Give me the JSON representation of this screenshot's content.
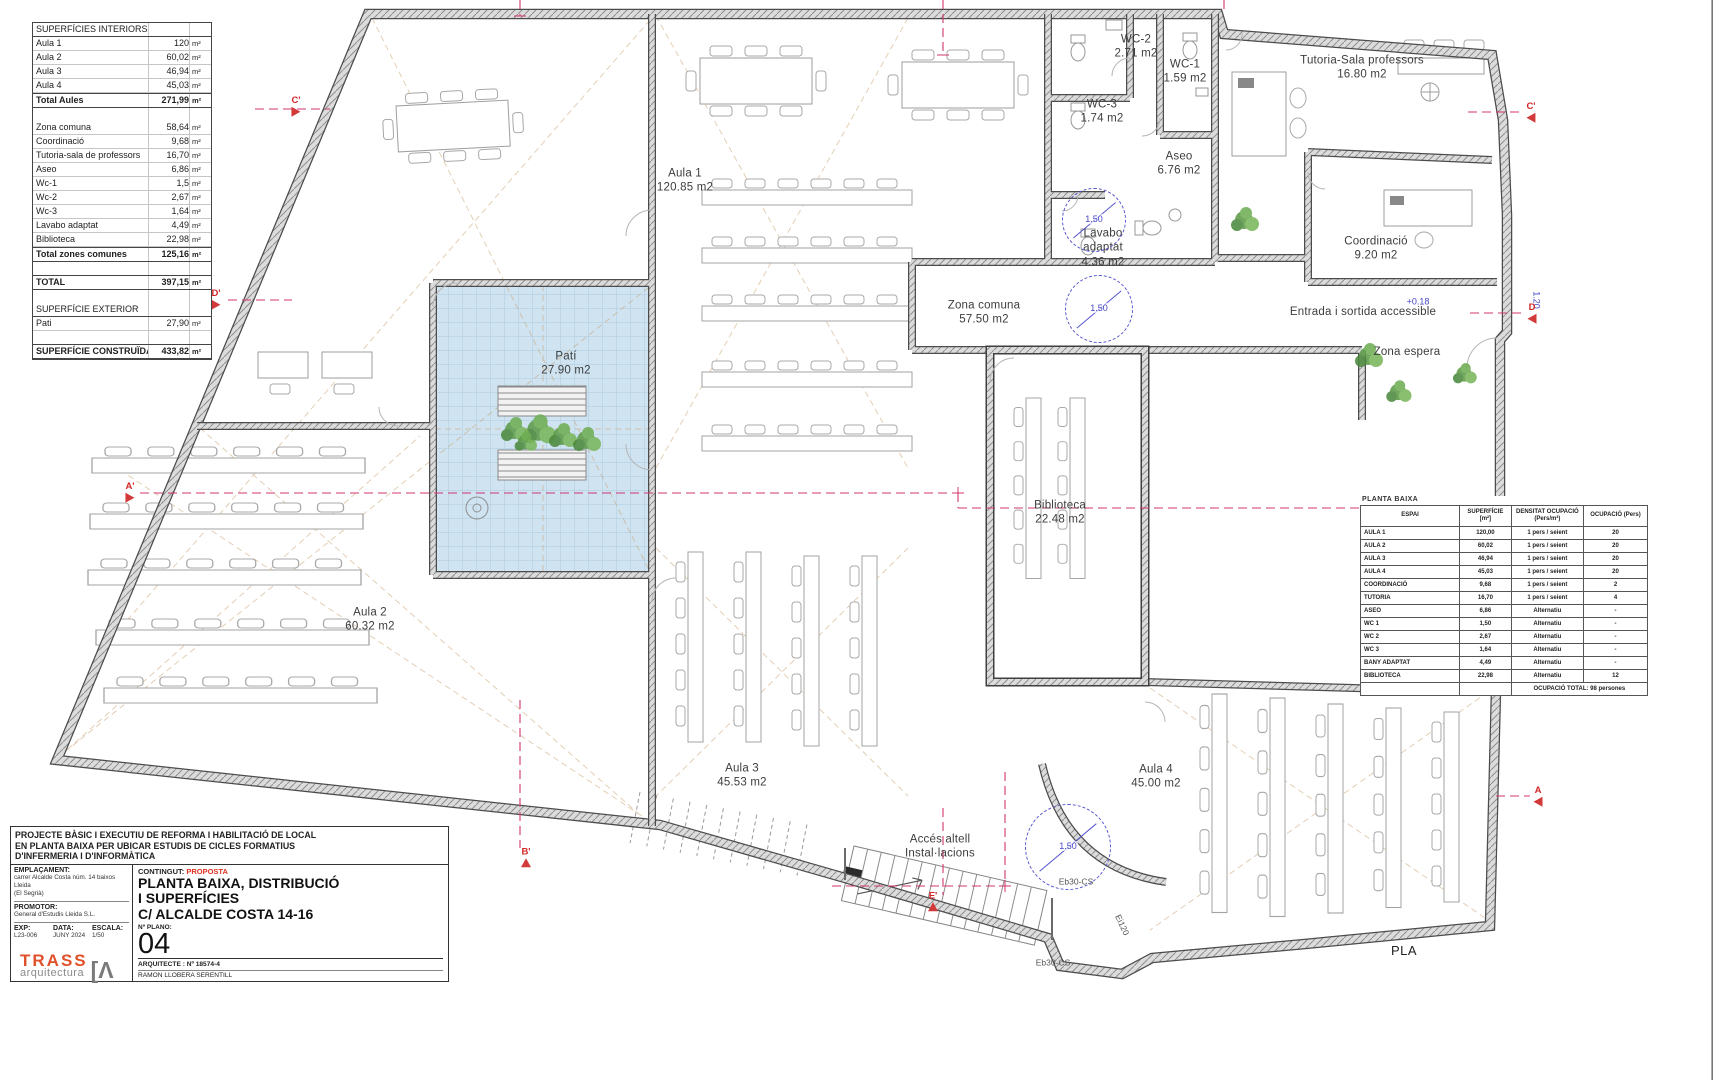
{
  "surfaces_table": {
    "rows": [
      {
        "label": "SUPERFÍCIES INTERIORS",
        "value": "",
        "unit": "",
        "style": "h"
      },
      {
        "label": "Aula 1",
        "value": "120",
        "unit": "m²"
      },
      {
        "label": "Aula 2",
        "value": "60,02",
        "unit": "m²"
      },
      {
        "label": "Aula 3",
        "value": "46,94",
        "unit": "m²"
      },
      {
        "label": "Aula 4",
        "value": "45,03",
        "unit": "m²"
      },
      {
        "label": "Total Aules",
        "value": "271,99",
        "unit": "m²",
        "style": "hb"
      },
      {
        "label": "",
        "value": "",
        "unit": "",
        "style": "blank"
      },
      {
        "label": "Zona comuna",
        "value": "58,64",
        "unit": "m²"
      },
      {
        "label": "Coordinació",
        "value": "9,68",
        "unit": "m²"
      },
      {
        "label": "Tutoria-sala de professors",
        "value": "16,70",
        "unit": "m²"
      },
      {
        "label": "Aseo",
        "value": "6,86",
        "unit": "m²"
      },
      {
        "label": "Wc-1",
        "value": "1,5",
        "unit": "m²"
      },
      {
        "label": "Wc-2",
        "value": "2,67",
        "unit": "m²"
      },
      {
        "label": "Wc-3",
        "value": "1,64",
        "unit": "m²"
      },
      {
        "label": "Lavabo adaptat",
        "value": "4,49",
        "unit": "m²"
      },
      {
        "label": "Biblioteca",
        "value": "22,98",
        "unit": "m²"
      },
      {
        "label": "Total zones comunes",
        "value": "125,16",
        "unit": "m²",
        "style": "hb"
      },
      {
        "label": "",
        "value": "",
        "unit": "",
        "style": "blank"
      },
      {
        "label": "TOTAL",
        "value": "397,15",
        "unit": "m²",
        "style": "hb"
      },
      {
        "label": "",
        "value": "",
        "unit": "",
        "style": "blank"
      },
      {
        "label": "SUPERFÍCIE EXTERIOR",
        "value": "",
        "unit": "",
        "style": "h"
      },
      {
        "label": "Pati",
        "value": "27,90",
        "unit": "m²"
      },
      {
        "label": "",
        "value": "",
        "unit": "",
        "style": "blank"
      },
      {
        "label": "SUPERFÍCIE CONSTRUÏDA",
        "value": "433,82",
        "unit": "m²",
        "style": "hb"
      }
    ]
  },
  "occupancy_table": {
    "title": "PLANTA BAIXA",
    "headers": [
      "ESPAI",
      "SUPERFÍCIE\n[m²]",
      "DENSITAT OCUPACIÓ\n(Pers/m²)",
      "OCUPACIÓ (Pers)"
    ],
    "rows": [
      [
        "AULA 1",
        "120,00",
        "1 pers / seient",
        "20"
      ],
      [
        "AULA 2",
        "60,02",
        "1 pers / seient",
        "20"
      ],
      [
        "AULA 3",
        "46,94",
        "1 pers / seient",
        "20"
      ],
      [
        "AULA 4",
        "45,03",
        "1 pers / seient",
        "20"
      ],
      [
        "COORDINACIÓ",
        "9,68",
        "1 pers / seient",
        "2"
      ],
      [
        "TUTORIA",
        "16,70",
        "1 pers / seient",
        "4"
      ],
      [
        "ASEO",
        "6,86",
        "Alternatiu",
        "-"
      ],
      [
        "WC 1",
        "1,50",
        "Alternatiu",
        "-"
      ],
      [
        "WC 2",
        "2,67",
        "Alternatiu",
        "-"
      ],
      [
        "WC 3",
        "1,64",
        "Alternatiu",
        "-"
      ],
      [
        "BANY ADAPTAT",
        "4,49",
        "Alternatiu",
        "-"
      ],
      [
        "BIBLIOTECA",
        "22,98",
        "Alternatiu",
        "12"
      ]
    ],
    "footer": "OCUPACIÓ TOTAL: 98 persones"
  },
  "plan_labels": [
    {
      "text": "WC-2\n2.71 m2",
      "x": 1136,
      "y": 47,
      "cls": "room"
    },
    {
      "text": "WC-1\n1.59 m2",
      "x": 1185,
      "y": 72,
      "cls": "room"
    },
    {
      "text": "WC-3\n1.74 m2",
      "x": 1102,
      "y": 112,
      "cls": "room"
    },
    {
      "text": "Tutoria-Sala professors\n16.80 m2",
      "x": 1362,
      "y": 68,
      "cls": "room"
    },
    {
      "text": "Aseo\n6.76 m2",
      "x": 1179,
      "y": 164,
      "cls": "room"
    },
    {
      "text": "Aula  1\n120.85 m2",
      "x": 685,
      "y": 181,
      "cls": "room"
    },
    {
      "text": "Lavabo\nadaptat\n4.36 m2",
      "x": 1103,
      "y": 248,
      "cls": "room"
    },
    {
      "text": "Coordinació\n9.20 m2",
      "x": 1376,
      "y": 249,
      "cls": "room"
    },
    {
      "text": "Zona comuna\n57.50 m2",
      "x": 984,
      "y": 313,
      "cls": "room"
    },
    {
      "text": "Entrada i sortida accessible",
      "x": 1363,
      "y": 312,
      "cls": "room"
    },
    {
      "text": "+0.18",
      "x": 1418,
      "y": 302,
      "cls": "blue"
    },
    {
      "text": "Zona espera",
      "x": 1407,
      "y": 352,
      "cls": "room"
    },
    {
      "text": "Patí\n27.90 m2",
      "x": 566,
      "y": 364,
      "cls": "room"
    },
    {
      "text": "Biblioteca\n22.48 m2",
      "x": 1060,
      "y": 513,
      "cls": "room"
    },
    {
      "text": "Aula  2\n60.32 m2",
      "x": 370,
      "y": 620,
      "cls": "room"
    },
    {
      "text": "Aula 3\n45.53 m2",
      "x": 742,
      "y": 776,
      "cls": "room"
    },
    {
      "text": "Aula 4\n45.00 m2",
      "x": 1156,
      "y": 777,
      "cls": "room"
    },
    {
      "text": "Accés altell\nInstal·lacions",
      "x": 940,
      "y": 847,
      "cls": "room"
    },
    {
      "text": "1.20",
      "x": 392,
      "y": 897,
      "cls": "dim"
    },
    {
      "text": "Eb30-CS",
      "x": 1076,
      "y": 882,
      "cls": "tiny"
    },
    {
      "text": "Ei120",
      "x": 1122,
      "y": 925,
      "cls": "tiny",
      "rot": 65
    },
    {
      "text": "Eb30-CS",
      "x": 1053,
      "y": 963,
      "cls": "tiny"
    },
    {
      "text": "1.20",
      "x": 1536,
      "y": 300,
      "cls": "blue",
      "rot": 90
    },
    {
      "text": "PLA",
      "x": 1404,
      "y": 951,
      "cls": "corner"
    }
  ],
  "section_markers": [
    {
      "label": "C'",
      "x": 296,
      "y": 106,
      "dir": "right"
    },
    {
      "label": "C'",
      "x": 1531,
      "y": 112,
      "dir": "left"
    },
    {
      "label": "D'",
      "x": 216,
      "y": 299,
      "dir": "right"
    },
    {
      "label": "D",
      "x": 1532,
      "y": 313,
      "dir": "left"
    },
    {
      "label": "A'",
      "x": 130,
      "y": 492,
      "dir": "right"
    },
    {
      "label": "A",
      "x": 1538,
      "y": 796,
      "dir": "left"
    },
    {
      "label": "B'",
      "x": 526,
      "y": 857,
      "dir": "up"
    },
    {
      "label": "E'",
      "x": 933,
      "y": 901,
      "dir": "up"
    }
  ],
  "dim_circles": [
    {
      "x": 1093,
      "y": 219,
      "r": 31,
      "label": "1.50"
    },
    {
      "x": 1098,
      "y": 308,
      "r": 33,
      "label": "1.50"
    },
    {
      "x": 1067,
      "y": 846,
      "r": 42,
      "label": "1.50"
    }
  ],
  "title_block": {
    "project": "PROJECTE BÀSIC I EXECUTIU DE REFORMA I HABILITACIÓ DE LOCAL\nEN PLANTA BAIXA PER UBICAR ESTUDIS  DE CICLES FORMATIUS\nD'INFERMERIA I D'INFORMÀTICA",
    "emplacament_label": "EMPLAÇAMENT:",
    "emplacament_value": "carrer Alcalde Costa núm. 14 baixos\nLleida\n(El Segrià)",
    "promotor_label": "PROMOTOR:",
    "promotor_value": "General d'Estudis Lleida S.L.",
    "exp_label": "EXP:",
    "exp_value": "L23-006",
    "data_label": "DATA:",
    "data_value": "JUNY 2024",
    "escala_label": "ESCALA:",
    "escala_value": "1/50",
    "logo_brand": "TRASS",
    "logo_sub": "arquitectura",
    "logo_mark": "[Λ",
    "contingut_label": "CONTINGUT:",
    "contingut_value": "PROPOSTA",
    "title": "PLANTA BAIXA, DISTRIBUCIÓ\n I SUPERFÍCIES\nC/ ALCALDE COSTA 14-16",
    "plano_label": "Nº PLANO:",
    "plano_number": "04",
    "arquitecte_line1": "ARQUITECTE :    Nº 18574-4",
    "arquitecte_line2": "RAMON  LLOBERA  SERENTILL"
  }
}
